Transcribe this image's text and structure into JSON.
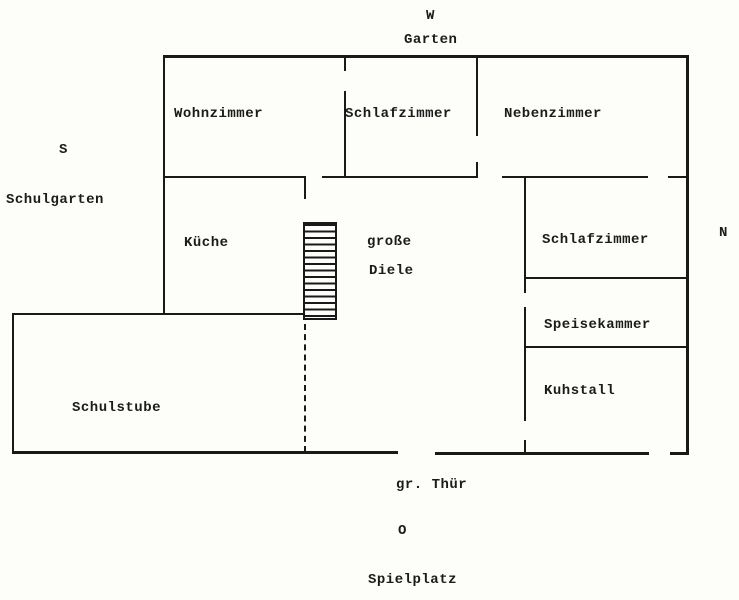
{
  "compass": {
    "west": "W",
    "south": "S",
    "north": "N",
    "east": "O"
  },
  "surroundings": {
    "garten": "Garten",
    "schulgarten": "Schulgarten",
    "spielplatz": "Spielplatz"
  },
  "rooms": {
    "wohnzimmer": "Wohnzimmer",
    "schlafzimmer_top": "Schlafzimmer",
    "nebenzimmer": "Nebenzimmer",
    "kueche": "Küche",
    "diele_line1": "große",
    "diele_line2": "Diele",
    "schlafzimmer_right": "Schlafzimmer",
    "speisekammer": "Speisekammer",
    "kuhstall": "Kuhstall",
    "schulstube": "Schulstube"
  },
  "annotations": {
    "grosse_tuer": "gr. Thür"
  },
  "colors": {
    "ink": "#1b1b1b",
    "paper": "#fdfdfa"
  }
}
